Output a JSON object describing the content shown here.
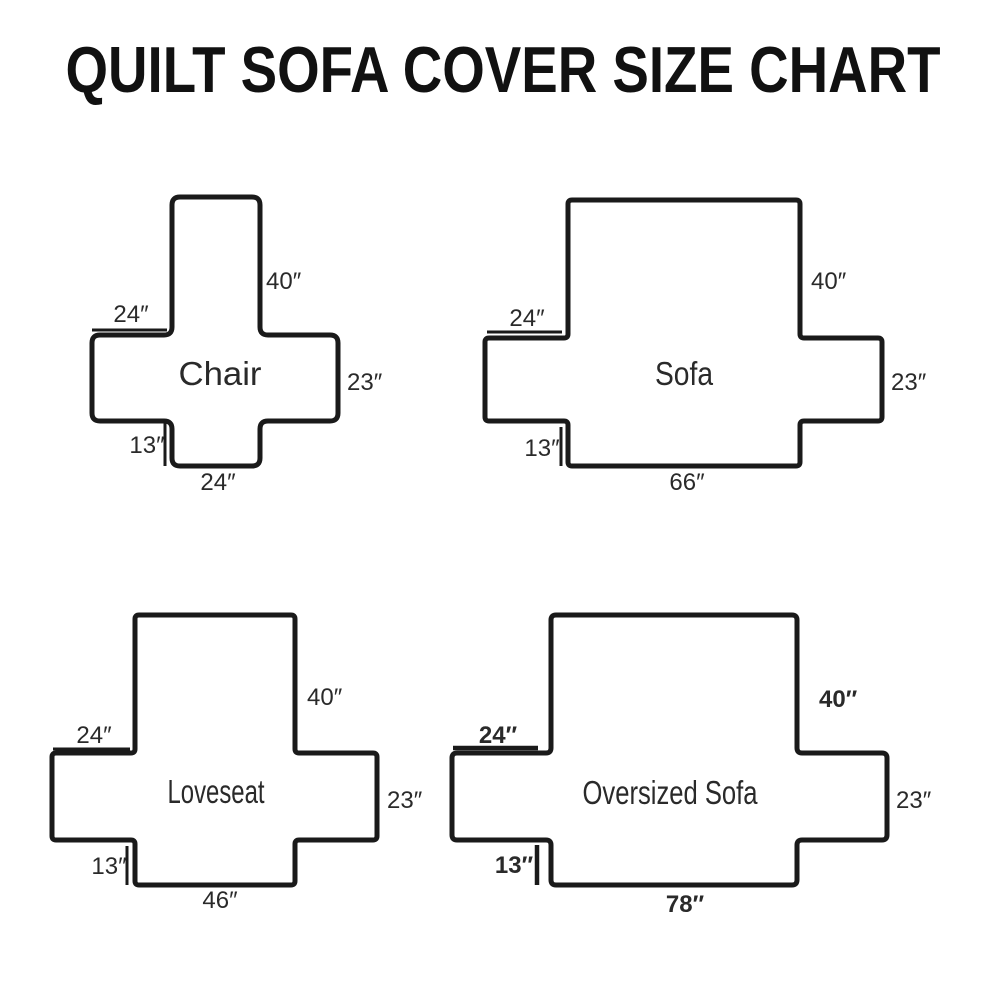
{
  "title": "QUILT SOFA COVER SIZE CHART",
  "colors": {
    "background": "#ffffff",
    "line": "#1a1a1a",
    "text": "#2a2a2a",
    "title": "#111111"
  },
  "diagrams": [
    {
      "name": "Chair",
      "back_height": "40″",
      "arm_width": "24″",
      "side_height": "23″",
      "skirt_drop": "13″",
      "base_width": "24″"
    },
    {
      "name": "Sofa",
      "back_height": "40″",
      "arm_width": "24″",
      "side_height": "23″",
      "skirt_drop": "13″",
      "base_width": "66″"
    },
    {
      "name": "Loveseat",
      "back_height": "40″",
      "arm_width": "24″",
      "side_height": "23″",
      "skirt_drop": "13″",
      "base_width": "46″"
    },
    {
      "name": "Oversized Sofa",
      "back_height": "40″",
      "arm_width": "24″",
      "side_height": "23″",
      "skirt_drop": "13″",
      "base_width": "78″"
    }
  ]
}
